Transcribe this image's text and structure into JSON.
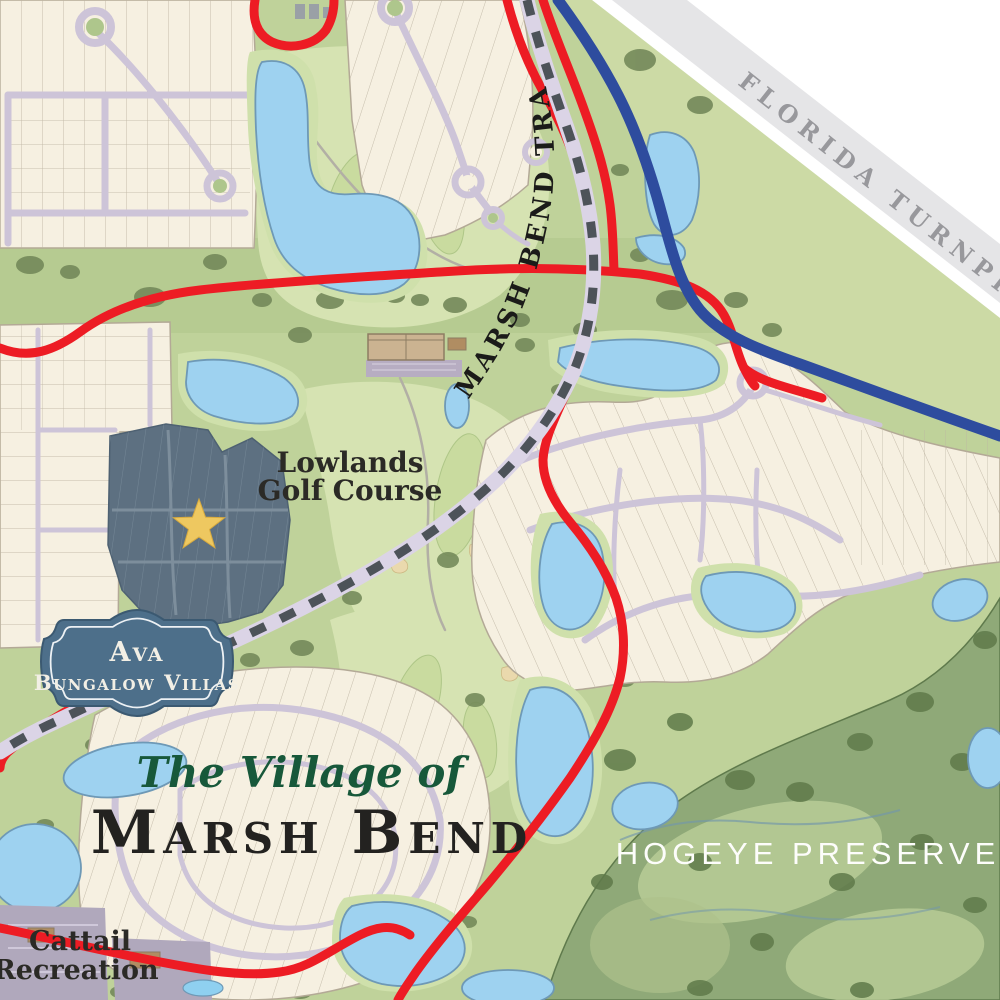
{
  "title": {
    "prefix": "The Village of",
    "name": "Marsh Bend"
  },
  "labels": {
    "turnpike": "FLORIDA TURNPIKE",
    "trail": "MARSH BEND TRAIL",
    "golf_line1": "Lowlands",
    "golf_line2": "Golf Course",
    "preserve": "HOGEYE PRESERVE",
    "recreation_line1": "Cattail",
    "recreation_line2": "Recreation"
  },
  "badge": {
    "line1": "Ava",
    "line2": "Bungalow Villas"
  },
  "colors": {
    "road_primary": "#ed1c24",
    "turnpike_road": "#2e4c9e",
    "trail_dash": "#4d5359",
    "site_highlight": "#5d7081",
    "star": "#eec860",
    "badge_bg": "#4d6f8a",
    "water": "#9ed2f0",
    "cream_lots": "#f6f0e1",
    "base_green": "#bfd29a",
    "preserve_green": "#8fa978",
    "title_green": "#17583a",
    "title_dark": "#232220",
    "turnpike_band": "#e5e5e7",
    "turnpike_band_text": "#98989c",
    "preserve_label": "#fdfdfb"
  }
}
